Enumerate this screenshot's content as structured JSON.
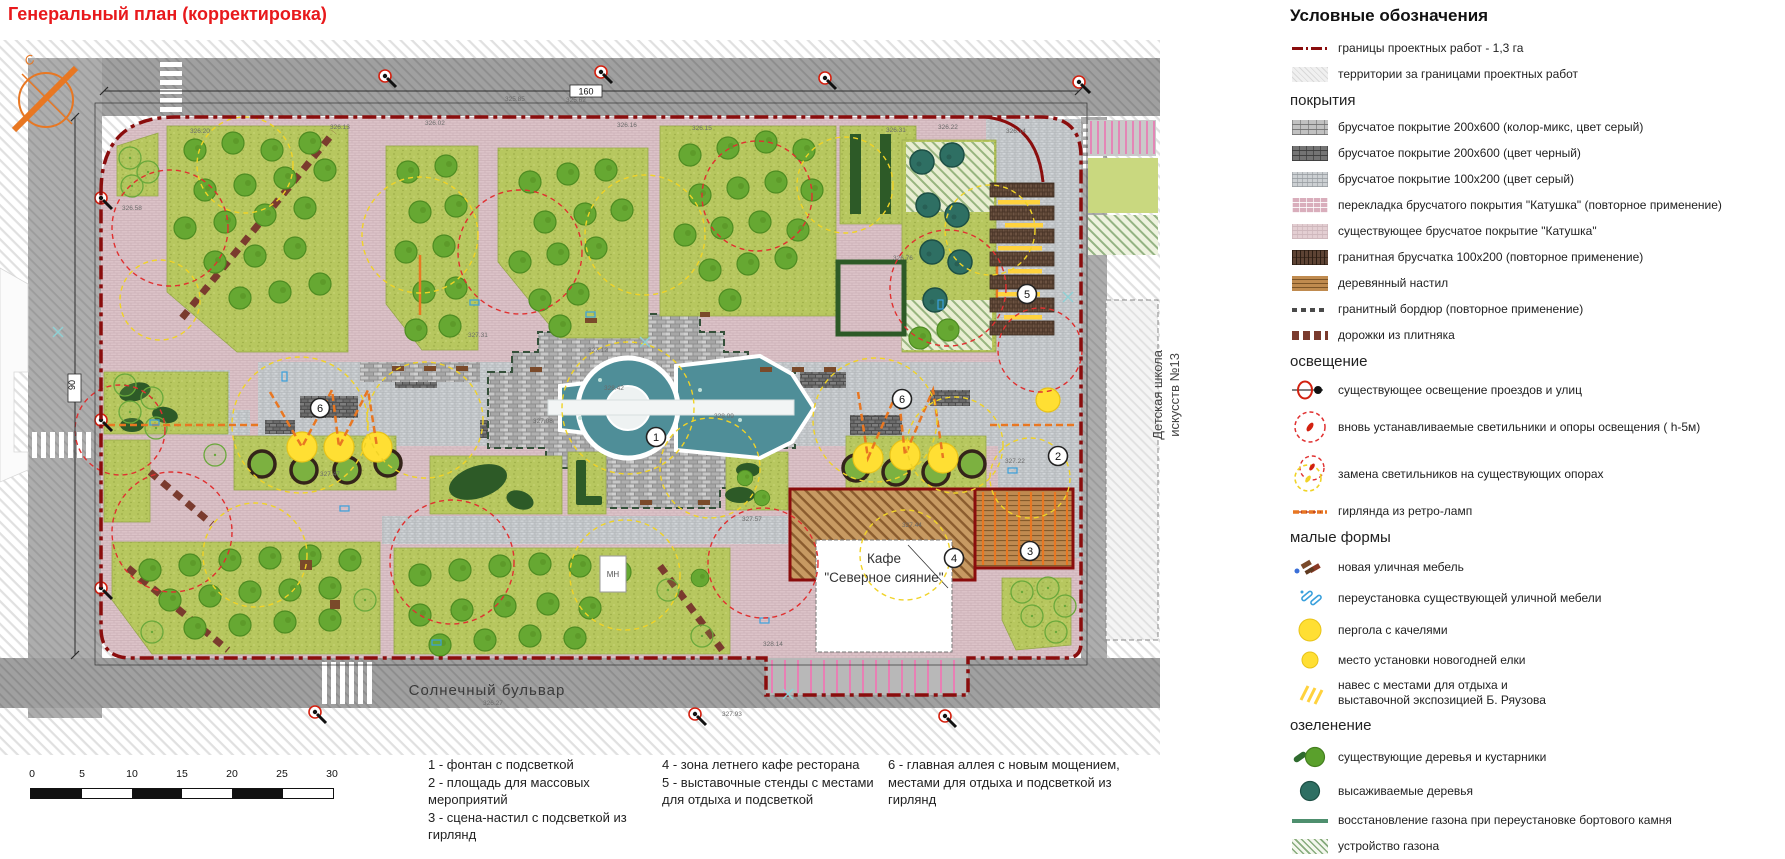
{
  "title": "Генеральный план (корректировка)",
  "plan": {
    "street_label": "Солнечный бульвар",
    "school_label_line1": "Детская школа",
    "school_label_line2": "искусств №13",
    "cafe_label_line1": "Кафе",
    "cafe_label_line2": "\"Северное сияние\"",
    "dim_top": "160",
    "dim_left": "90",
    "compass_letter": "С",
    "mn_label": "МН",
    "markers": {
      "m1": "1",
      "m2": "2",
      "m3": "3",
      "m4": "4",
      "m5": "5",
      "m6": "6"
    },
    "spots": [
      "325.85",
      "325.62",
      "326.20",
      "326.13",
      "326.02",
      "326.16",
      "326.15",
      "326.31",
      "326.22",
      "326.14",
      "326.58",
      "327.31",
      "327.12",
      "328.42",
      "327.08",
      "328.09",
      "327.47",
      "327.57",
      "327.44",
      "328.14",
      "326.27",
      "327.93",
      "326.76",
      "327.22"
    ]
  },
  "legend": {
    "title": "Условные обозначения",
    "sections": {
      "coverings": "покрытия",
      "lighting": "освещение",
      "small_forms": "малые формы",
      "greening": "озеленение"
    },
    "items": {
      "boundary": "границы проектных работ - 1,3 га",
      "territory": "территории за границами проектных работ",
      "c1": "брусчатое покрытие 200х600 (колор-микс, цвет серый)",
      "c2": "брусчатое покрытие 200х600 (цвет черный)",
      "c3": "брусчатое покрытие 100х200 (цвет серый)",
      "c4": "перекладка брусчатого покрытия \"Катушка\" (повторное применение)",
      "c5": "существующее брусчатое покрытие \"Катушка\"",
      "c6": "гранитная брусчатка 100х200 (повторное применение)",
      "c7": "деревянный настил",
      "c8": "гранитный бордюр (повторное применение)",
      "c9": "дорожки из плитняка",
      "l1": "существующее освещение проездов и улиц",
      "l2": "вновь устанавливаемые светильники и опоры освещения ( h-5м)",
      "l3": "замена светильников на существующих опорах",
      "l4": "гирлянда из ретро-ламп",
      "s1": "новая уличная мебель",
      "s2": "переустановка существующей уличной мебели",
      "s3": "пергола с качелями",
      "s4": "место установки новогодней елки",
      "s5a": "навес с местами для отдыха и",
      "s5b": "выставочной экспозицией Б. Ряузова",
      "g1": "существующие деревья и кустарники",
      "g2": "высаживаемые деревья",
      "g3": "восстановление газона при переустановке бортового камня",
      "g4": "устройство газона"
    }
  },
  "notes": {
    "col1": [
      "1 - фонтан с подсветкой",
      "2 - площадь для массовых",
      "мероприятий",
      "3 - сцена-настил с подсветкой из",
      "гирлянд"
    ],
    "col2": [
      "4 - зона летнего кафе ресторана",
      "5 - выставочные стенды с местами",
      "для отдыха и подсветкой"
    ],
    "col3": [
      "6 - главная аллея с новым мощением,",
      "местами для отдыха и подсветкой из",
      "гирлянд"
    ]
  },
  "scale": {
    "ticks": [
      "0",
      "5",
      "10",
      "15",
      "20",
      "25",
      "30"
    ]
  },
  "colors": {
    "title_red": "#e8191c",
    "boundary_red": "#8a0d0d",
    "katushka_pink": "#dcc3c8",
    "lawn_green": "#b7c75f",
    "tree_green": "#66a832",
    "tree_teal": "#2e6f63",
    "hedge_dark_green": "#2d5a27",
    "fountain_teal": "#4f8e98",
    "pergola_yellow": "#ffdf33",
    "garland_orange": "#e87722",
    "wood_brown": "#bf8a50",
    "granite_brown": "#5d4334",
    "parking_pink": "#e87fb4",
    "street_gray": "#9e9e9e"
  }
}
